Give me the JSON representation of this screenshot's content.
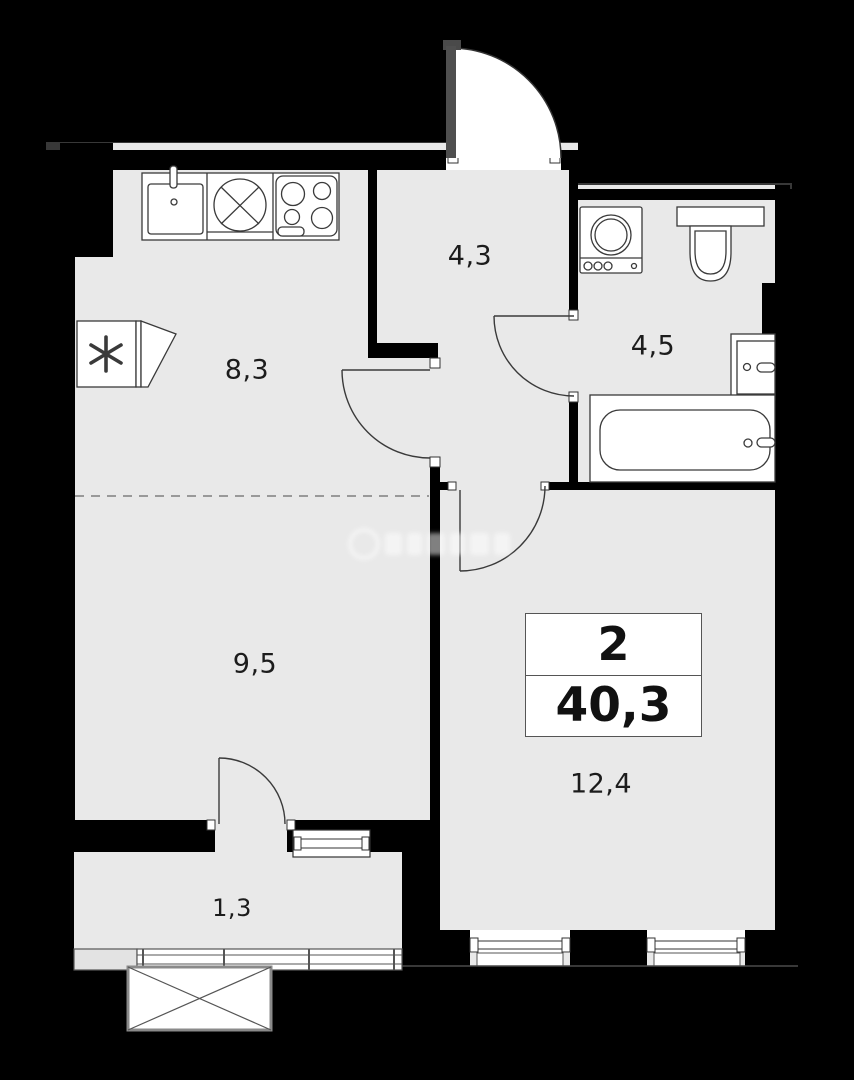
{
  "floor_plan": {
    "background_color": "#000000",
    "floor_color": "#e9e9e9",
    "wall_color": "#000000",
    "outline_color": "#3a3a3a",
    "rooms": [
      {
        "id": "kitchen",
        "area": "8,3"
      },
      {
        "id": "hallway",
        "area": "4,3"
      },
      {
        "id": "bathroom",
        "area": "4,5"
      },
      {
        "id": "living-room",
        "area": "9,5"
      },
      {
        "id": "bedroom",
        "area": "12,4"
      },
      {
        "id": "balcony",
        "area": "1,3"
      }
    ],
    "summary_box": {
      "rooms_count": "2",
      "total_area": "40,3"
    },
    "fixtures": [
      "kitchen-sink",
      "washing-machine-kitchen",
      "stove-4-burner",
      "refrigerator",
      "washing-machine-bathroom",
      "toilet",
      "bathroom-sink",
      "bathtub"
    ]
  }
}
